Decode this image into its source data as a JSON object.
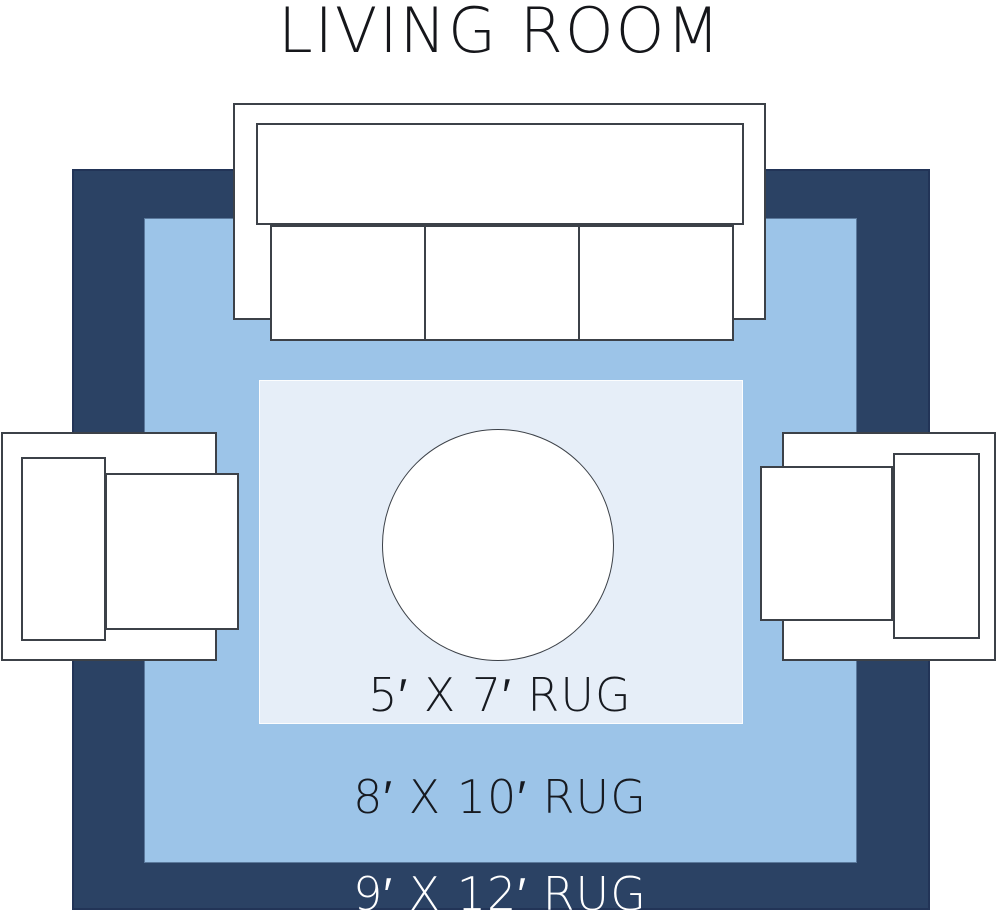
{
  "title": "LIVING ROOM",
  "rugs": {
    "small": {
      "label": "5′ X 7′ RUG"
    },
    "medium": {
      "label": "8′ X 10′ RUG"
    },
    "large": {
      "label": "9′ X 12′ RUG"
    }
  },
  "colors": {
    "rug-large": "#2b4264",
    "rug-medium": "#9cc4e8",
    "rug-small": "#e6eef8",
    "furniture-fill": "#ffffff",
    "furniture-outline": "#3c4148",
    "title-text": "#15161a",
    "label-dark": "#171a20",
    "label-light": "#ffffff",
    "background": "#ffffff"
  }
}
